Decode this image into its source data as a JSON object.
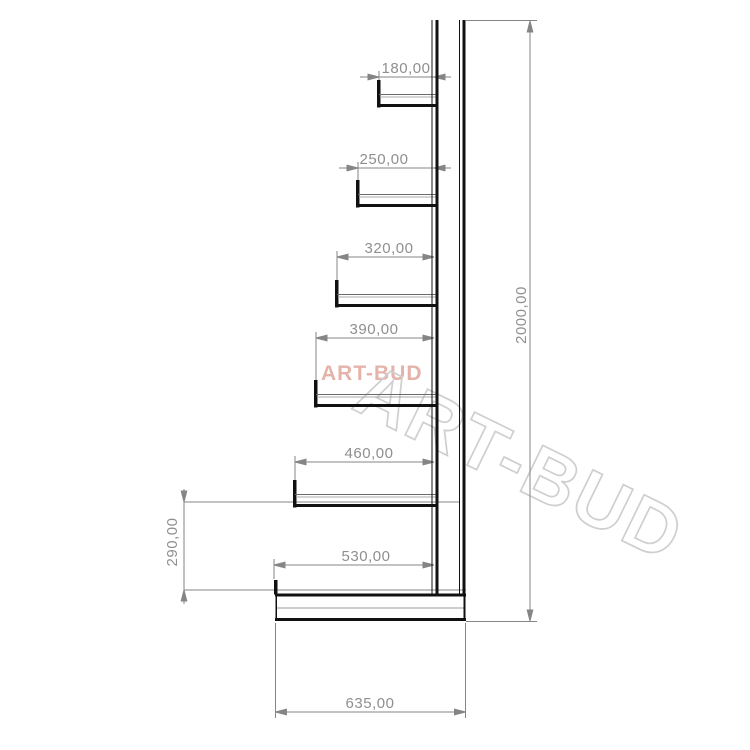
{
  "drawing": {
    "title": "Cantilever rack side-view technical drawing",
    "watermarks": {
      "small": "ART-BUD",
      "large": "ART-BUD",
      "small_color": "#e4b3aa",
      "large_color": "#cfcfcf"
    },
    "dimension_labels": {
      "arm_1": "180,00",
      "arm_2": "250,00",
      "arm_3": "320,00",
      "arm_4": "390,00",
      "arm_5": "460,00",
      "arm_6": "530,00",
      "base_depth": "635,00",
      "total_height": "2000,00",
      "arm_to_base": "290,00"
    },
    "colors": {
      "structure_line": "#111111",
      "dimension_line": "#858585",
      "dimension_text": "#8f8f8f"
    }
  }
}
